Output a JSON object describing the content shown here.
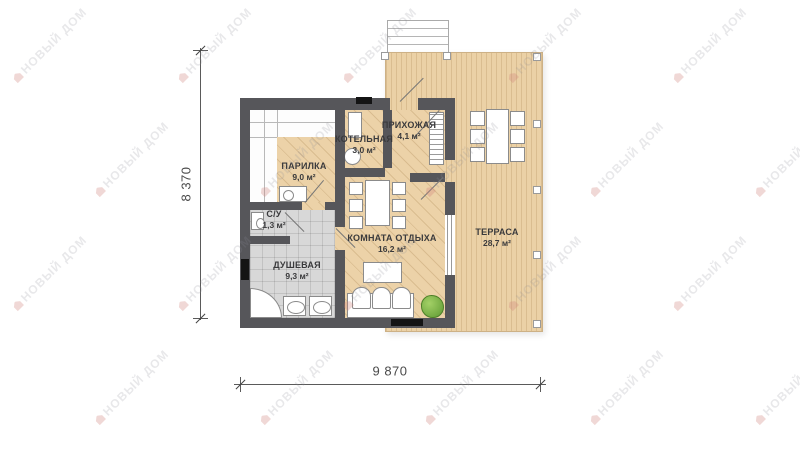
{
  "watermark": {
    "text": "НОВЫЙ ДОМ"
  },
  "dimensions": {
    "height_label": "8 370",
    "width_label": "9 870"
  },
  "rooms": {
    "parilka": {
      "name": "ПАРИЛКА",
      "area": "9,0 м²"
    },
    "kotelnaya": {
      "name": "КОТЕЛЬНАЯ",
      "area": "3,0 м²"
    },
    "prihozhaya": {
      "name": "ПРИХОЖАЯ",
      "area": "4,1 м²"
    },
    "su": {
      "name": "С/У",
      "area": "1,3 м²"
    },
    "dushevaya": {
      "name": "ДУШЕВАЯ",
      "area": "9,3 м²"
    },
    "komnata_otdyha": {
      "name": "КОМНАТА ОТДЫХА",
      "area": "16,2 м²"
    },
    "terrasa": {
      "name": "ТЕРРАСА",
      "area": "28,7 м²"
    }
  },
  "colors": {
    "wall": "#56565a",
    "wood": "#ecd2a8",
    "terrace": "#ebd1a6",
    "tile": "#d8d8d8",
    "plant": "#76b043",
    "label": "#3a3a3c",
    "dim": "#4a4a4a",
    "black": "#141414"
  }
}
